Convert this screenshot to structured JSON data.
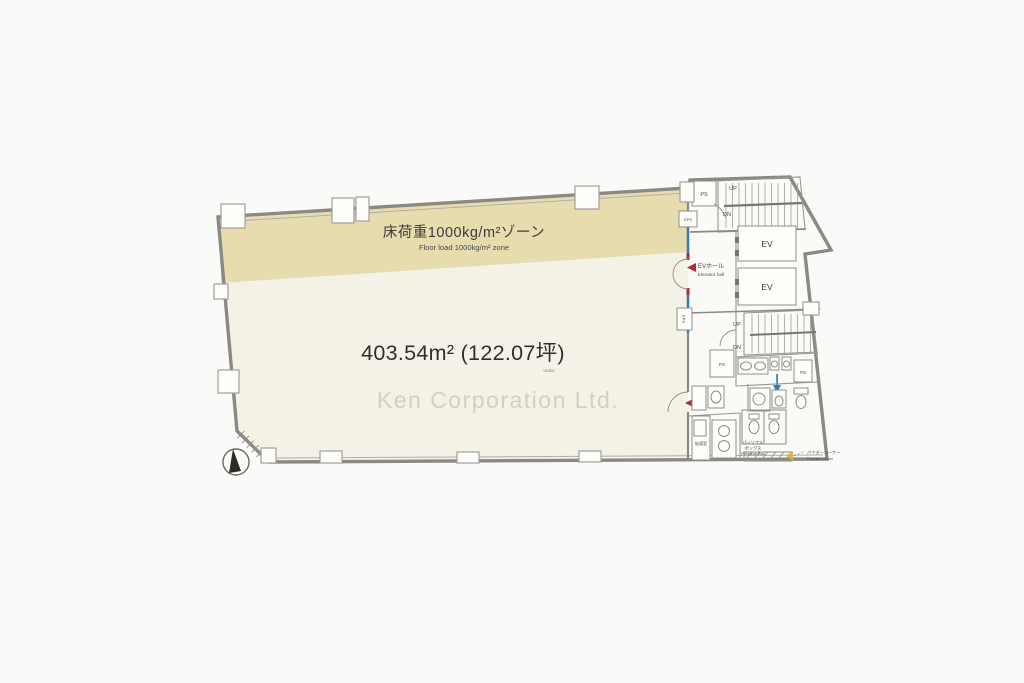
{
  "page": {
    "background": "#fafaf8"
  },
  "plan": {
    "zone": {
      "label_jp": "床荷重1000kg/m²ゾーン",
      "label_en": "Floor load 1000kg/m² zone"
    },
    "area": {
      "label": "403.54m² (122.07坪)",
      "unit_note": "tsubo"
    },
    "watermark": "Ken Corporation Ltd.",
    "core": {
      "elevator_hall_jp": "EVホール",
      "elevator_hall_en": "Elevator hall",
      "elevator": "EV",
      "up": "UP",
      "down": "DN",
      "pipe_shaft": "PS",
      "electric_pipe_shaft": "EPS",
      "personal_box_jp_line1": "パーソナル",
      "personal_box_jp_line2": "ボックス",
      "personal_box_en": "Personal Box",
      "powder_corner_jp": "パウダーコーナー",
      "powder_corner_en": "Powder corner",
      "hot_water_room_jp": "給湯室"
    },
    "colors": {
      "zone_beige": "#e7dcae",
      "office_floor": "#f4f1e6",
      "core_floor": "#fbfaf6",
      "wall_gray": "#8b8984",
      "boundary_blue": "#2e7cb8",
      "entry_red": "#b5293a",
      "powder_mark_yellow": "#d9b64a"
    }
  }
}
